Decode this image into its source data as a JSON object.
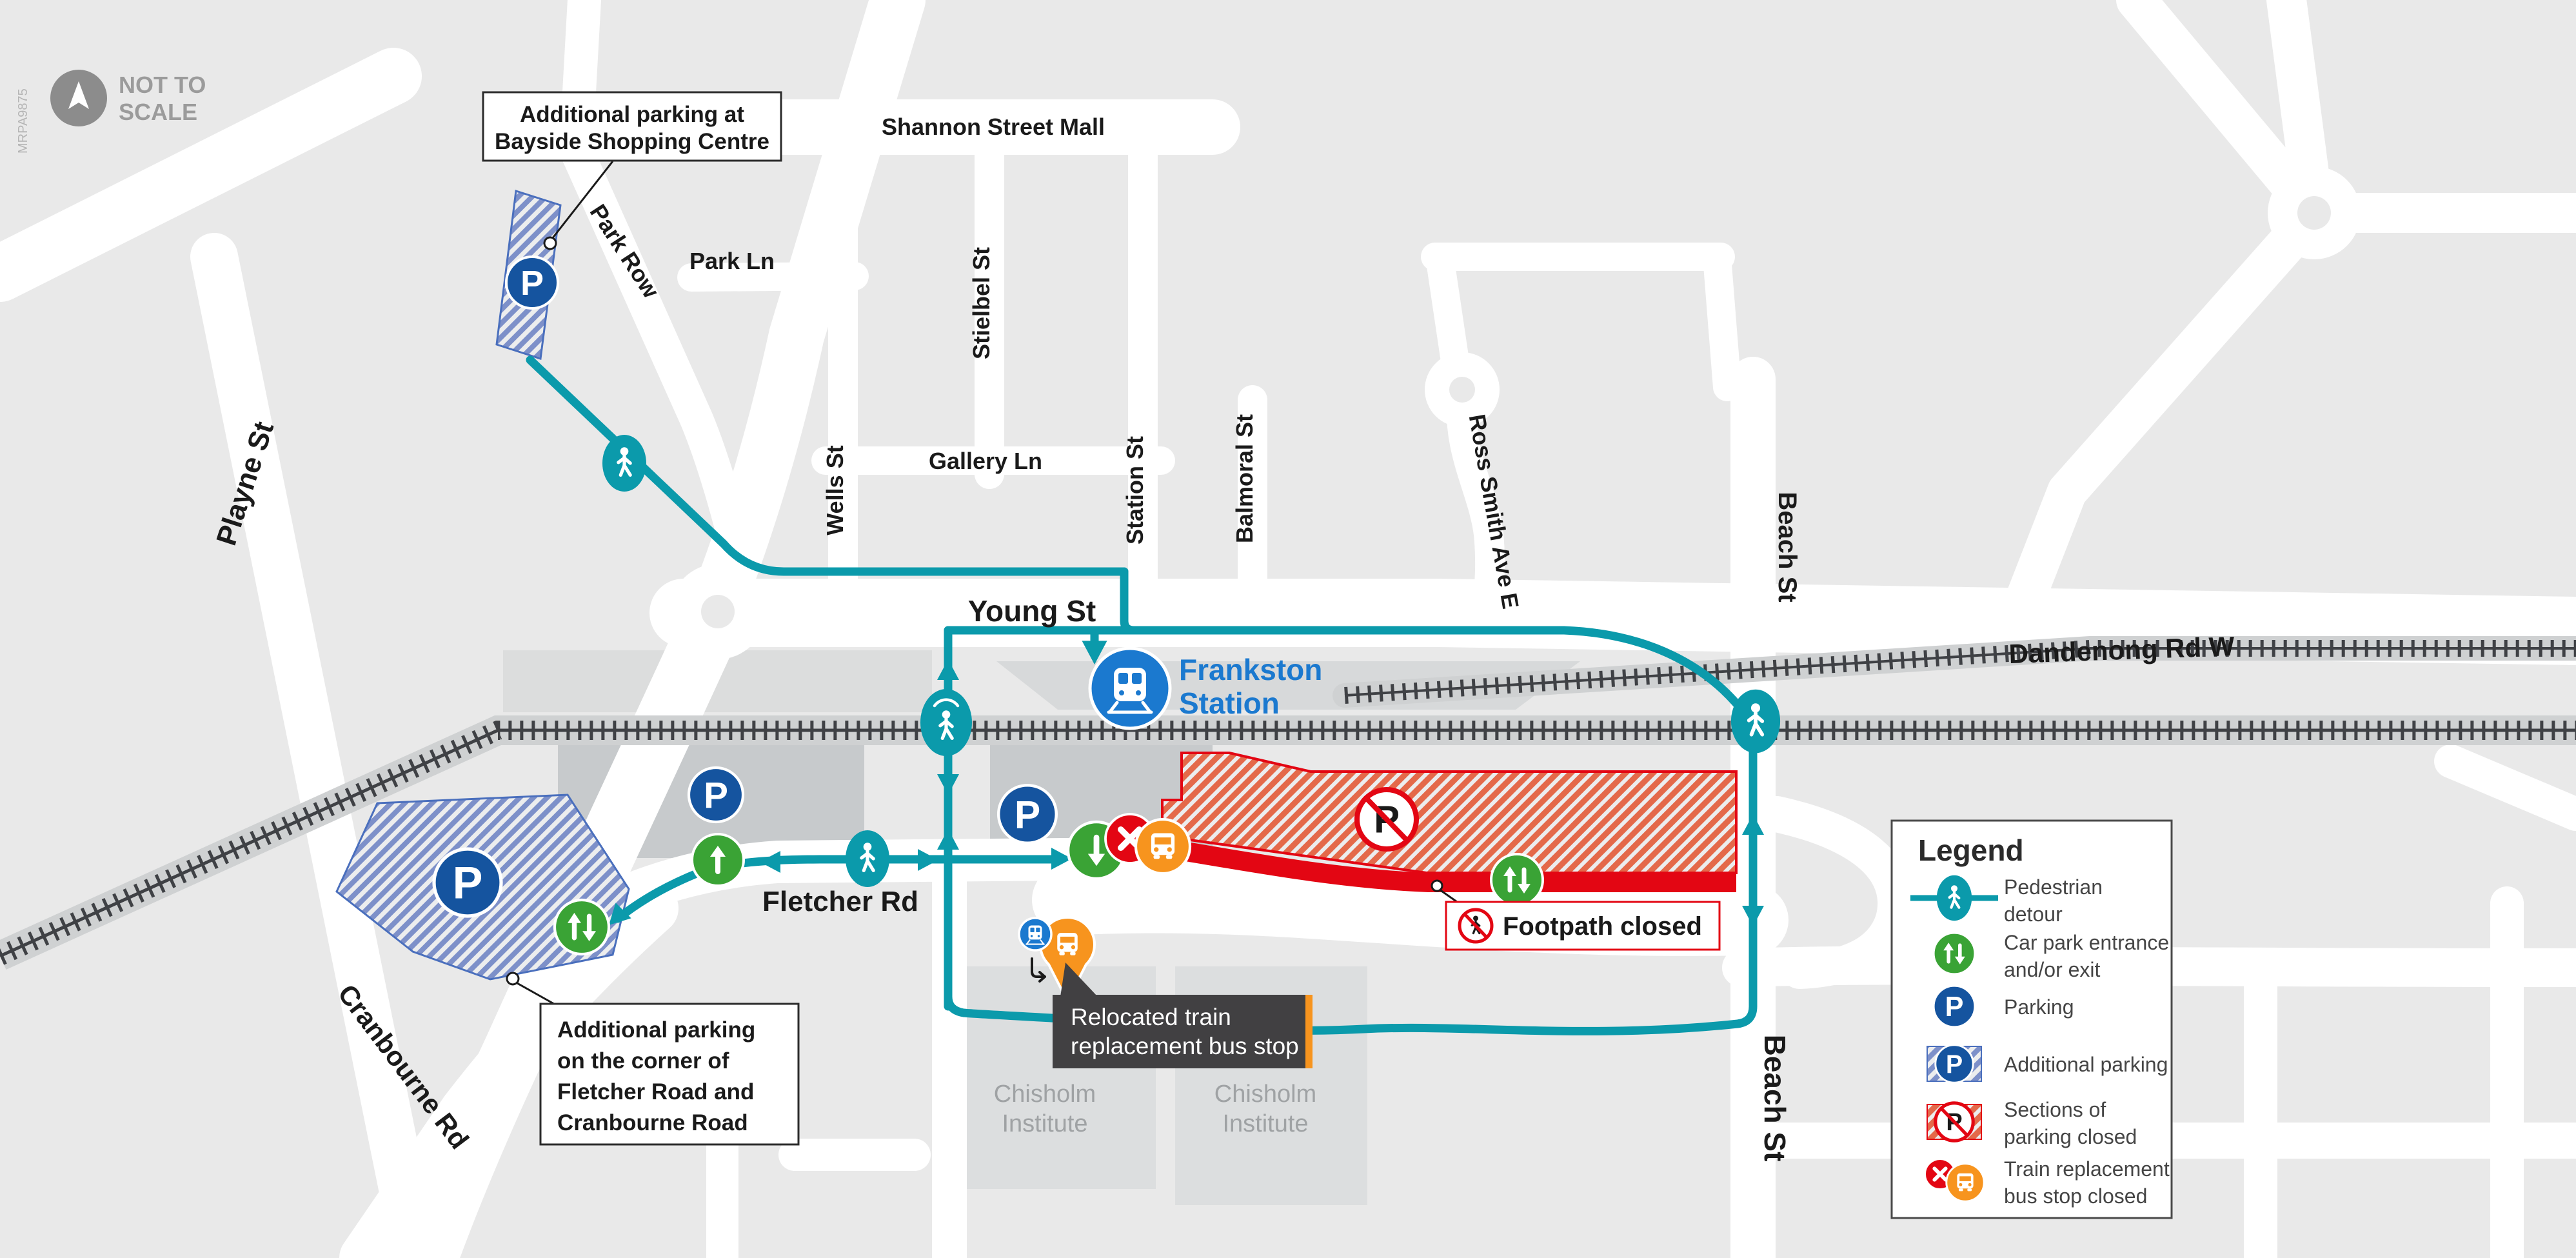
{
  "meta": {
    "ref_code": "MRPA9875",
    "not_to_scale_line1": "NOT TO",
    "not_to_scale_line2": "SCALE"
  },
  "icons": {
    "parking_letter": "P"
  },
  "streets": {
    "shannon": "Shannon Street Mall",
    "park_row": "Park Row",
    "park_ln": "Park Ln",
    "stielbel": "Stielbel St",
    "wells": "Wells St",
    "gallery": "Gallery Ln",
    "station_st": "Station St",
    "balmoral": "Balmoral St",
    "ross_smith": "Ross Smith Ave E",
    "beach": "Beach St",
    "dandenong": "Dandenong Rd W",
    "playne": "Playne St",
    "young": "Young St",
    "fletcher": "Fletcher Rd",
    "cranbourne": "Cranbourne Rd"
  },
  "station": {
    "line1": "Frankston",
    "line2": "Station"
  },
  "places": {
    "chisholm_line1": "Chisholm",
    "chisholm_line2": "Institute"
  },
  "callouts": {
    "bayside": [
      "Additional parking at",
      "Bayside Shopping Centre"
    ],
    "corner": [
      "Additional parking",
      "on the corner of",
      "Fletcher Road and",
      "Cranbourne Road"
    ],
    "relocated": [
      "Relocated train",
      "replacement bus stop"
    ],
    "footpath": "Footpath closed"
  },
  "legend": {
    "title": "Legend",
    "items": [
      {
        "name": "pedestrian-detour",
        "lines": [
          "Pedestrian",
          "detour"
        ]
      },
      {
        "name": "carpark-entrance",
        "lines": [
          "Car park entrance",
          "and/or exit"
        ]
      },
      {
        "name": "parking",
        "lines": [
          "Parking",
          ""
        ]
      },
      {
        "name": "additional-parking",
        "lines": [
          "Additional parking",
          ""
        ]
      },
      {
        "name": "parking-closed",
        "lines": [
          "Sections of",
          "parking closed"
        ]
      },
      {
        "name": "bus-stop-closed",
        "lines": [
          "Train replacement",
          "bus stop closed"
        ]
      }
    ]
  },
  "colors": {
    "background": "#e9e9e9",
    "road_white": "#ffffff",
    "railway_gray": "#cfd1d2",
    "detour_teal": "#0b9aab",
    "parking_blue": "#15549f",
    "station_blue": "#1b79cf",
    "entrance_green": "#3aa335",
    "bus_orange": "#f7941e",
    "closed_red": "#e30613",
    "hatch_red_stripe": "#e4694a",
    "hatch_blue_stripe": "#7d90c9",
    "tooltip_gray": "#414042"
  }
}
